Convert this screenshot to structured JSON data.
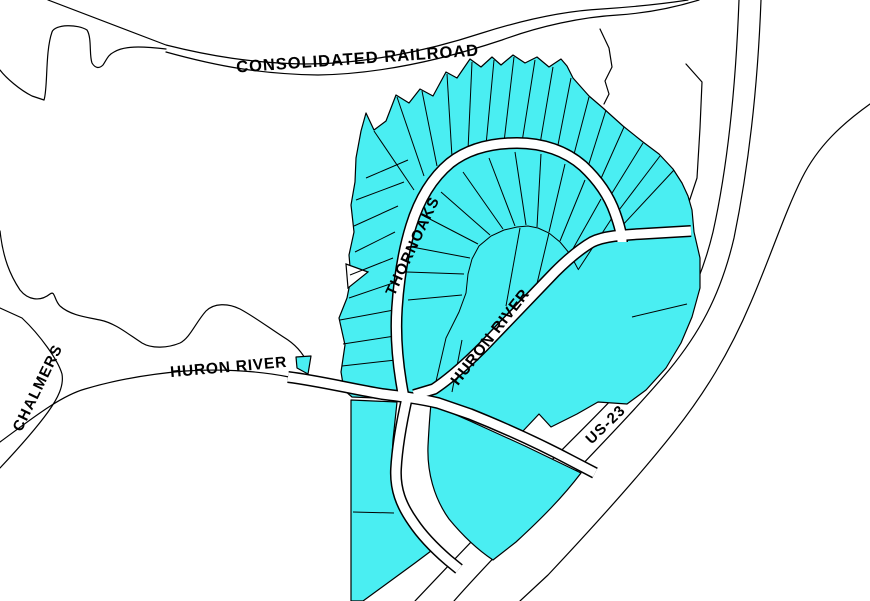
{
  "map": {
    "labels": {
      "railroad": "CONSOLIDATED RAILROAD",
      "thornoaks": "THORNOAKS",
      "huron_river_west": "HURON RIVER",
      "huron_river_diagonal": "HURON RIVER",
      "chalmers": "CHALMERS",
      "us23": "US-23"
    },
    "colors": {
      "highlight": "#4AEEF2",
      "line": "#000000",
      "road": "#FFFFFF",
      "background": "#FFFFFF"
    }
  }
}
